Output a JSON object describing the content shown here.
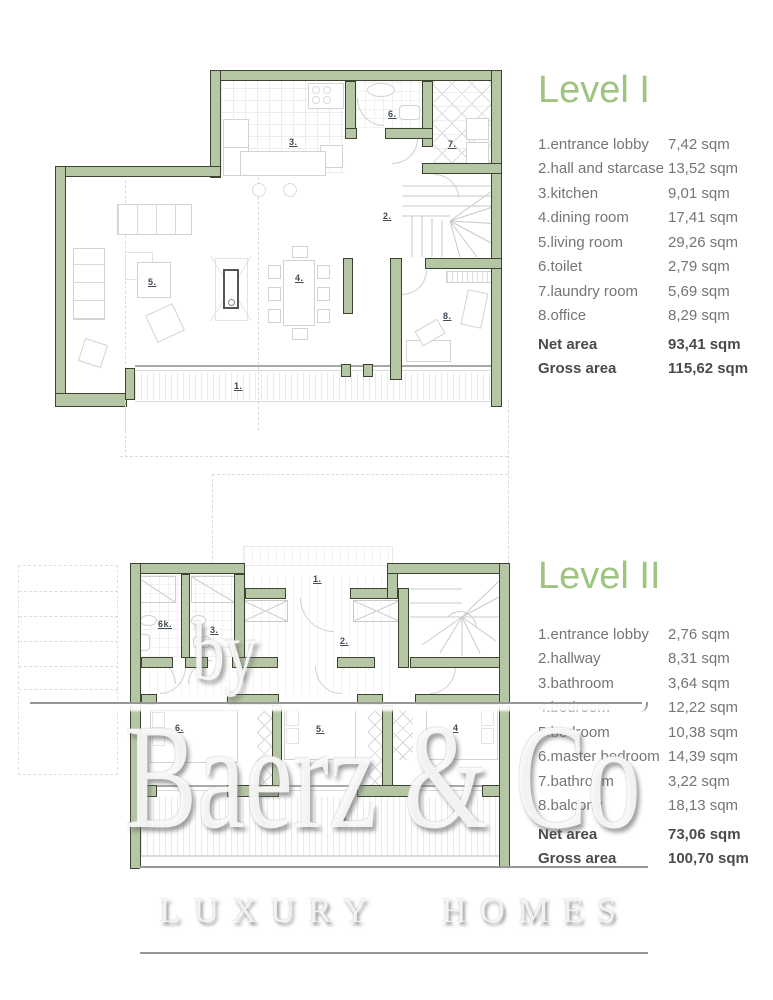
{
  "level1": {
    "title": "Level I",
    "rooms": [
      {
        "label": "1.entrance lobby",
        "area": "7,42 sqm"
      },
      {
        "label": "2.hall and starcase",
        "area": "13,52 sqm"
      },
      {
        "label": "3.kitchen",
        "area": "9,01 sqm"
      },
      {
        "label": "4.dining room",
        "area": "17,41 sqm"
      },
      {
        "label": "5.living room",
        "area": "29,26 sqm"
      },
      {
        "label": "6.toilet",
        "area": "2,79 sqm"
      },
      {
        "label": "7.laundry room",
        "area": "5,69 sqm"
      },
      {
        "label": "8.office",
        "area": "8,29 sqm"
      }
    ],
    "net": {
      "label": "Net area",
      "area": "93,41 sqm"
    },
    "gross": {
      "label": "Gross area",
      "area": "115,62 sqm"
    },
    "plan_labels": {
      "r1": "1.",
      "r2": "2.",
      "r3": "3.",
      "r4": "4.",
      "r5": "5.",
      "r6": "6.",
      "r7": "7.",
      "r8": "8."
    }
  },
  "level2": {
    "title": "Level II",
    "rooms": [
      {
        "label": "1.entrance lobby",
        "area": "2,76 sqm"
      },
      {
        "label": "2.hallway",
        "area": "8,31 sqm"
      },
      {
        "label": "3.bathroom",
        "area": "3,64 sqm"
      },
      {
        "label": "4.bedroom",
        "area": "12,22 sqm"
      },
      {
        "label": "5.bedroom",
        "area": "10,38 sqm"
      },
      {
        "label": "6.master bedroom",
        "area": "14,39 sqm"
      },
      {
        "label": "7.bathroom",
        "area": "3,22 sqm"
      },
      {
        "label": "8.balcony",
        "area": "18,13 sqm"
      }
    ],
    "net": {
      "label": "Net area",
      "area": "73,06 sqm"
    },
    "gross": {
      "label": "Gross area",
      "area": "100,70 sqm"
    },
    "plan_labels": {
      "r1": "1.",
      "r2": "2.",
      "r3": "3.",
      "r4": "4",
      "r5": "5.",
      "r6": "6.",
      "r6k": "6k.",
      "r7": "7."
    }
  },
  "watermark": {
    "by": "by",
    "brand": "Baerz & Co",
    "tagline": "LUXURY HOMES"
  },
  "colors": {
    "wall_fill": "#b4c6a3",
    "wall_edge": "#3c4331",
    "title_green": "#9fc480",
    "legend_text": "#757575",
    "totals_text": "#4b4b4b",
    "room_label": "#414c56"
  }
}
